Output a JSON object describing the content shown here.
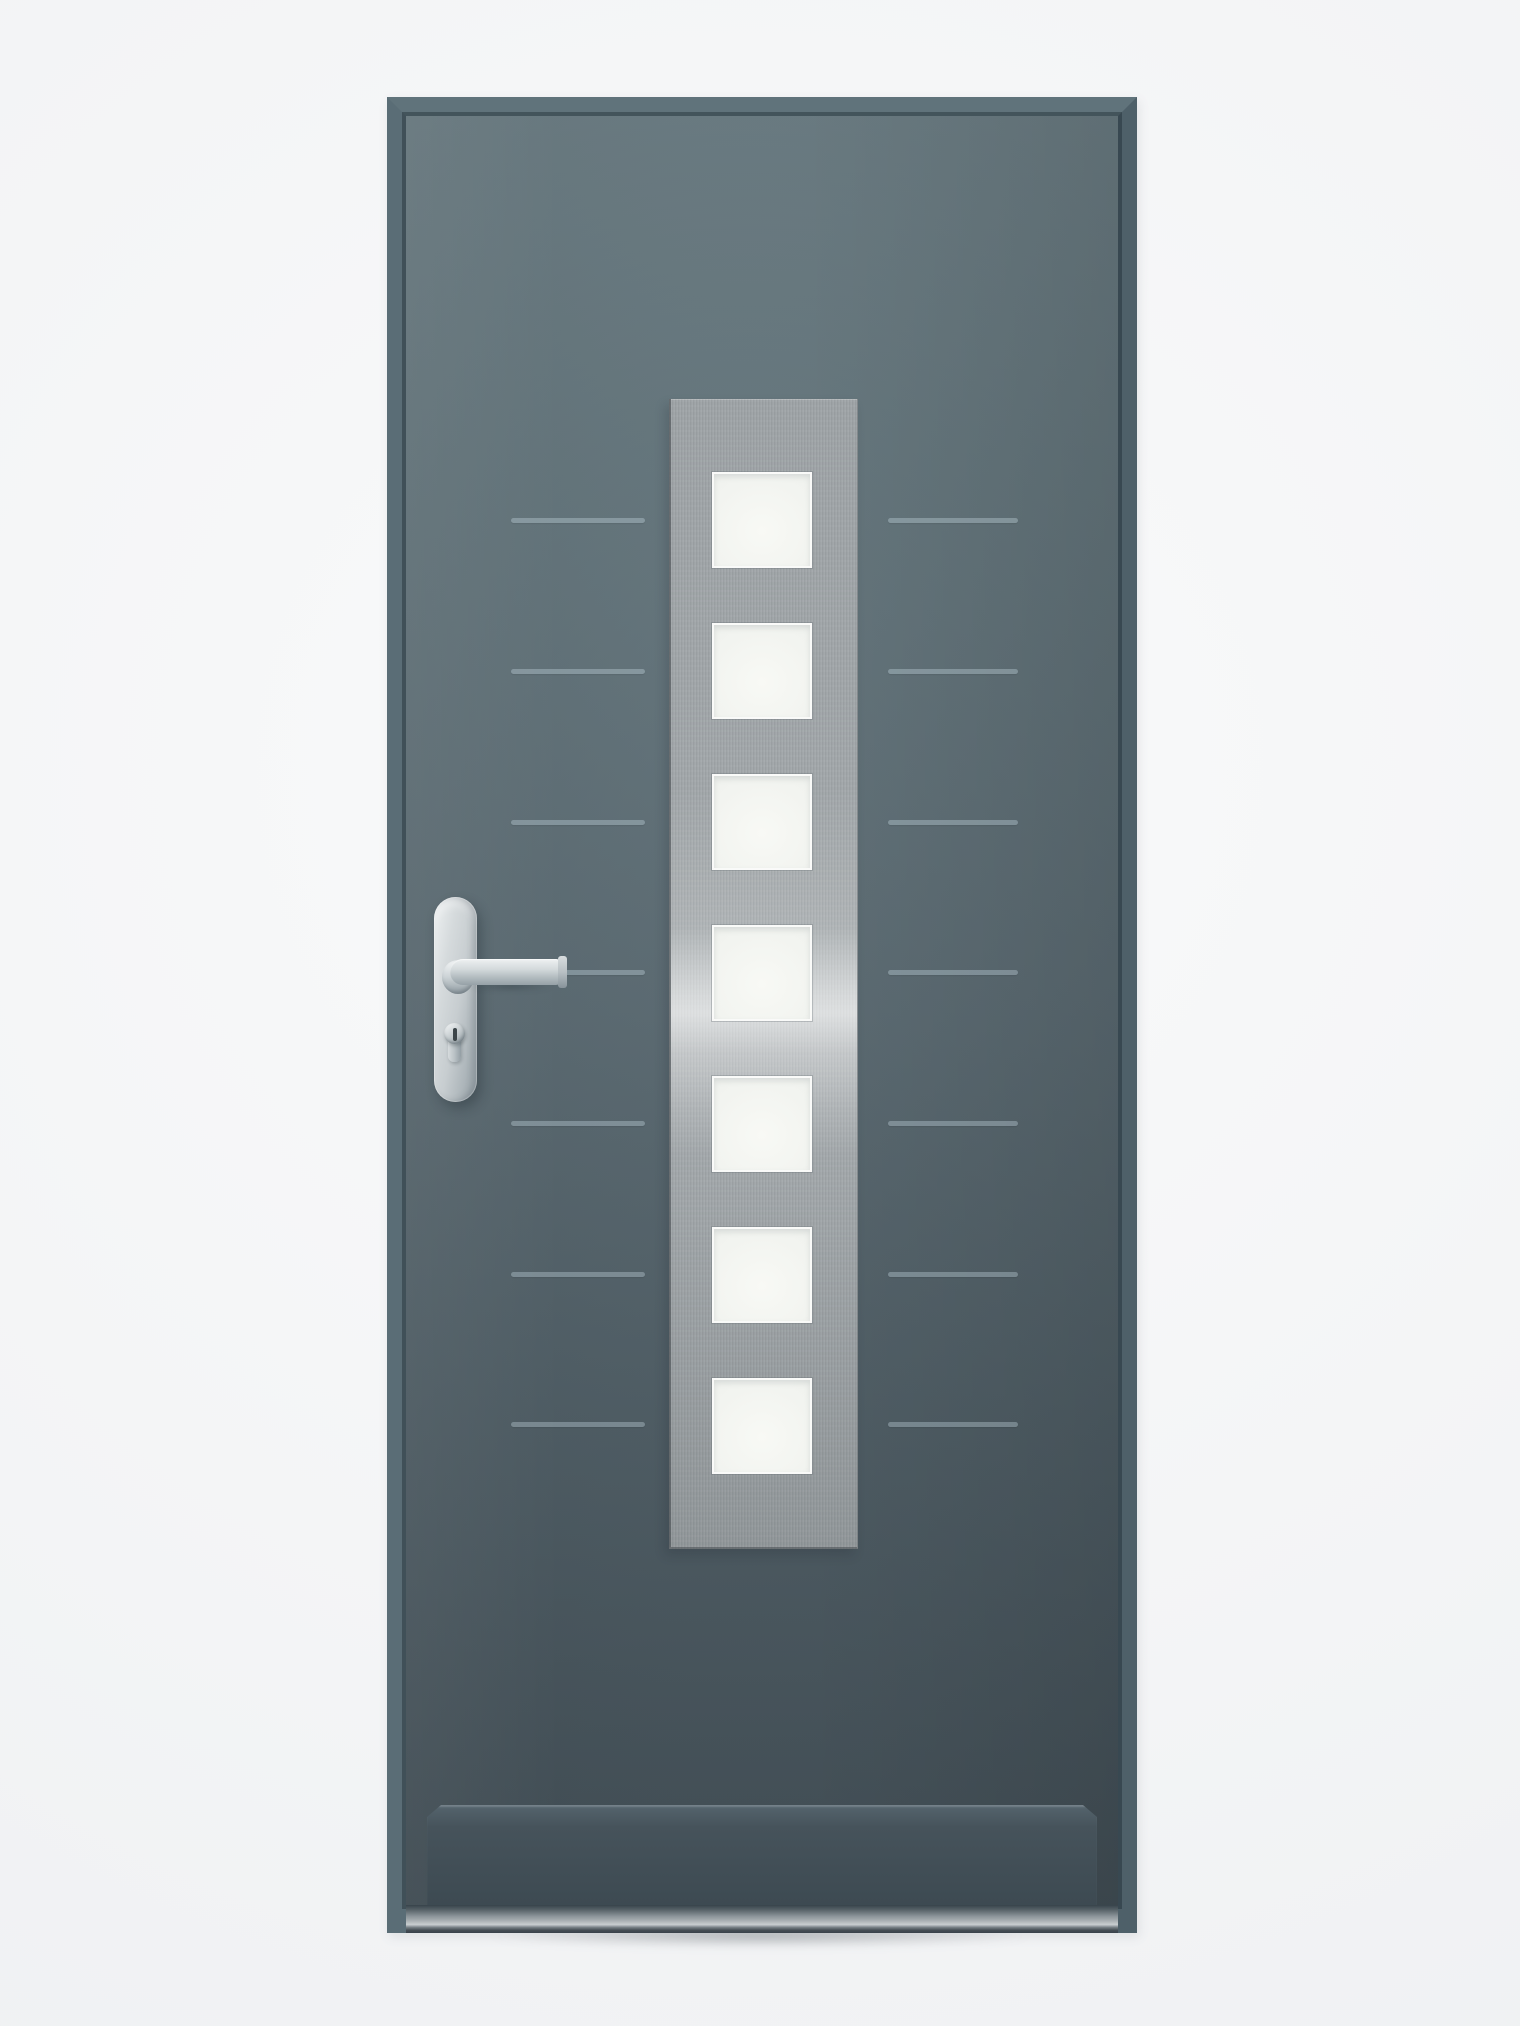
{
  "image_kind": "product-photograph",
  "subject": "modern-aluminium-entrance-door",
  "stage": {
    "width": 1520,
    "height": 2026
  },
  "colors": {
    "bg": "#f3f4f6",
    "leaf_top": "#66787f",
    "leaf_upper": "#5e7077",
    "leaf_mid": "#55656d",
    "leaf_low": "#4b5a62",
    "leaf_bottom": "#414e56",
    "frame_light": "#60737b",
    "frame_side": "#5a6d76",
    "frame_dark": "#4e6069",
    "groove": "rgba(210,231,239,0.32)",
    "panel_base": "#9da2a5",
    "panel_light": "#b6bbbd",
    "panel_dark": "#8f9598",
    "glass_hi": "#f8f9f5",
    "glass_lo": "#e8ebe7",
    "steel_hi": "#eef1f2",
    "steel_mid": "#c7cdd0",
    "steel_lo": "#96a1a7",
    "kick_face": "#46535b",
    "kick_dark": "#3d4a52",
    "kick_edge": "#62717a",
    "sill_bright": "#c9ced0",
    "sill_mid": "#8b9499",
    "sill_dark": "#37434a"
  },
  "frame": {
    "x": 387,
    "y": 97,
    "width": 750,
    "height": 1836,
    "thickness": 19
  },
  "leaf": {
    "x": 406,
    "y": 116,
    "width": 712,
    "height": 1789
  },
  "glazing_panel": {
    "x": 669,
    "y": 399,
    "width": 186,
    "height": 1148,
    "finish": "brushed-stainless",
    "square_count": 7,
    "square_left": 712,
    "square_width": 100,
    "square_height": 96,
    "square_tops": [
      472,
      623,
      774,
      925,
      1076,
      1227,
      1378
    ]
  },
  "grooves": {
    "count_per_side": 7,
    "y_centers": [
      520,
      671,
      822,
      972,
      1123,
      1274,
      1424
    ],
    "left": {
      "x": 511,
      "length": 134
    },
    "right": {
      "x": 888,
      "length": 130
    },
    "thickness": 5
  },
  "hardware": {
    "finish": "stainless-steel",
    "backplate": {
      "x": 434,
      "y": 897,
      "width": 43,
      "height": 205
    },
    "lever": {
      "x": 434,
      "y": 950,
      "length": 130,
      "thickness": 26,
      "direction": "right"
    },
    "cylinder": {
      "x": 444,
      "y": 1023,
      "width": 21,
      "height": 40,
      "type": "euro-profile"
    }
  },
  "kick_plate": {
    "x": 427,
    "y": 1805,
    "width": 670,
    "height": 100,
    "bevel": 14
  },
  "threshold": {
    "x": 406,
    "y": 1905,
    "width": 712,
    "height": 28
  }
}
